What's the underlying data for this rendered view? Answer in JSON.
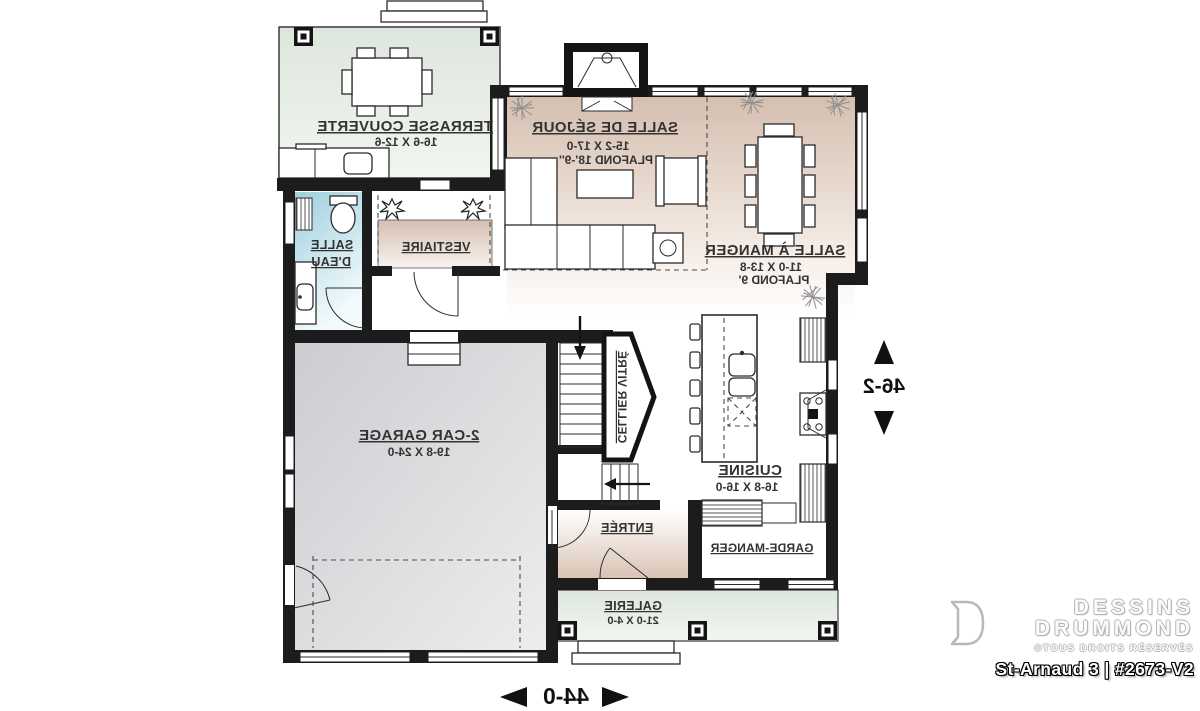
{
  "branding": {
    "name1": "DESSINS",
    "name2": "DRUMMOND",
    "rights": "©TOUS DROITS RÉSERVÉS",
    "plan": "St-Arnaud 3 | #2673-V2"
  },
  "dims": {
    "width": "44-0",
    "depth": "46-2"
  },
  "rooms": {
    "terrasse": {
      "name": "TERRASSE COUVERTE",
      "dims": "16-6 X 12-6"
    },
    "sejour": {
      "name": "SALLE DE SÉJOUR",
      "dims": "15-2 X 17-0",
      "ceiling": "PLAFOND 18'-9''"
    },
    "manger": {
      "name": "SALLE À MANGER",
      "dims": "11-0 X 13-8",
      "ceiling": "PLAFOND 9'"
    },
    "salle_eau": {
      "line1": "SALLE",
      "line2": "D'EAU"
    },
    "vestiaire": {
      "name": "VESTIAIRE"
    },
    "garage": {
      "name": "2-CAR GARAGE",
      "dims": "19-8 X 24-0"
    },
    "cellier": {
      "name": "CELLIER VITRÉ"
    },
    "cuisine": {
      "name": "CUISINE",
      "dims": "16-8 X 16-0"
    },
    "entree": {
      "name": "ENTRÉE"
    },
    "garde_manger": {
      "name": "GARDE-MANGER"
    },
    "galerie": {
      "name": "GALERIE",
      "dims": "21-0 X 4-0"
    }
  },
  "colors": {
    "wall": "#1c1c1c",
    "room_beige": "#d5bfb0",
    "terrace_green": "#dde6dc",
    "water_blue": "#9fd0dd",
    "garage_gray": "#cccdd1",
    "label": "#333333"
  },
  "note": "Plan graphic is horizontally mirrored; branding block is not mirrored."
}
